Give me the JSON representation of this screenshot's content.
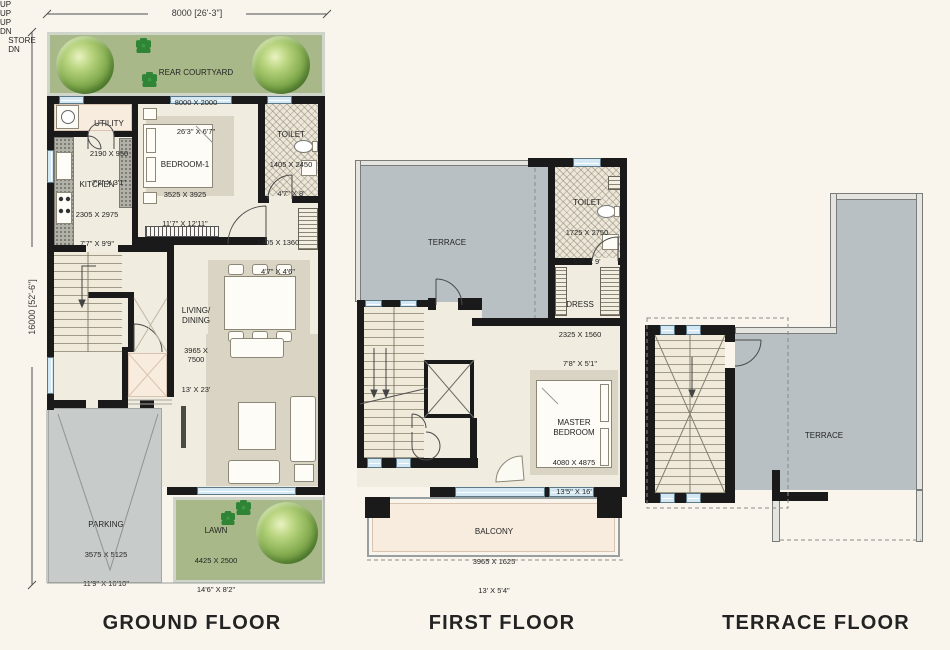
{
  "dimensions": {
    "top": "8000 [26'-3\"]",
    "left": "16000 [52'-6\"]"
  },
  "titles": {
    "ground": "GROUND FLOOR",
    "first": "FIRST FLOOR",
    "terrace": "TERRACE FLOOR"
  },
  "ground": {
    "rear_courtyard": {
      "name": "REAR COURTYARD",
      "mm": "8000 X 2000",
      "ft": "26'3\" X 6'7\""
    },
    "utility": {
      "name": "UTILITY",
      "mm": "2190 X 950",
      "ft": "7'2\" X 3'1\""
    },
    "kitchen": {
      "name": "KITCHEN",
      "mm": "2305 X 2975",
      "ft": "7'7\" X 9'9\""
    },
    "bedroom1": {
      "name": "BEDROOM-1",
      "mm": "3525 X 3925",
      "ft": "11'7\" X 12'11\""
    },
    "toilet": {
      "name": "TOILET",
      "mm": "1405 X 2450",
      "ft": "4'7\" X 8'"
    },
    "passage": {
      "mm": "1405 X 1360",
      "ft": "4'7\" X 4'6\""
    },
    "living_dining": {
      "name": "LIVING/\nDINING",
      "mm": "3965 X\n7500",
      "ft": "13' X 23'"
    },
    "parking": {
      "name": "PARKING",
      "mm": "3575 X 5125",
      "ft": "11'9\" X 16'10\""
    },
    "lawn": {
      "name": "LAWN",
      "mm": "4425 X 2500",
      "ft": "14'6\" X 8'2\""
    },
    "stair_label": "UP",
    "porch_label": "UP"
  },
  "first": {
    "terrace": {
      "name": "TERRACE"
    },
    "toilet": {
      "name": "TOILET",
      "mm": "1725 X 2750",
      "ft": "5'8\" X 9'"
    },
    "dress": {
      "name": "DRESS",
      "mm": "2325 X 1560",
      "ft": "7'8\" X 5'1\""
    },
    "store": {
      "name": "STORE"
    },
    "master_bedroom": {
      "name": "MASTER\nBEDROOM",
      "mm": "4080 X 4875",
      "ft": "13'5\" X 16'"
    },
    "balcony": {
      "name": "BALCONY",
      "mm": "3965 X 1625",
      "ft": "13' X 5'4\""
    },
    "up_label": "UP",
    "dn_label": "DN"
  },
  "terrace_floor": {
    "terrace": {
      "name": "TERRACE"
    },
    "dn_label": "DN"
  },
  "colors": {
    "wall": "#1a1a1a",
    "floor": "#f0ecdf",
    "green": "#a8b888",
    "terrace_gray": "#b9c0c3",
    "parking_gray": "#c7cbca",
    "accent_pink": "#f8ecdf",
    "window_blue": "#d3e8f3"
  }
}
